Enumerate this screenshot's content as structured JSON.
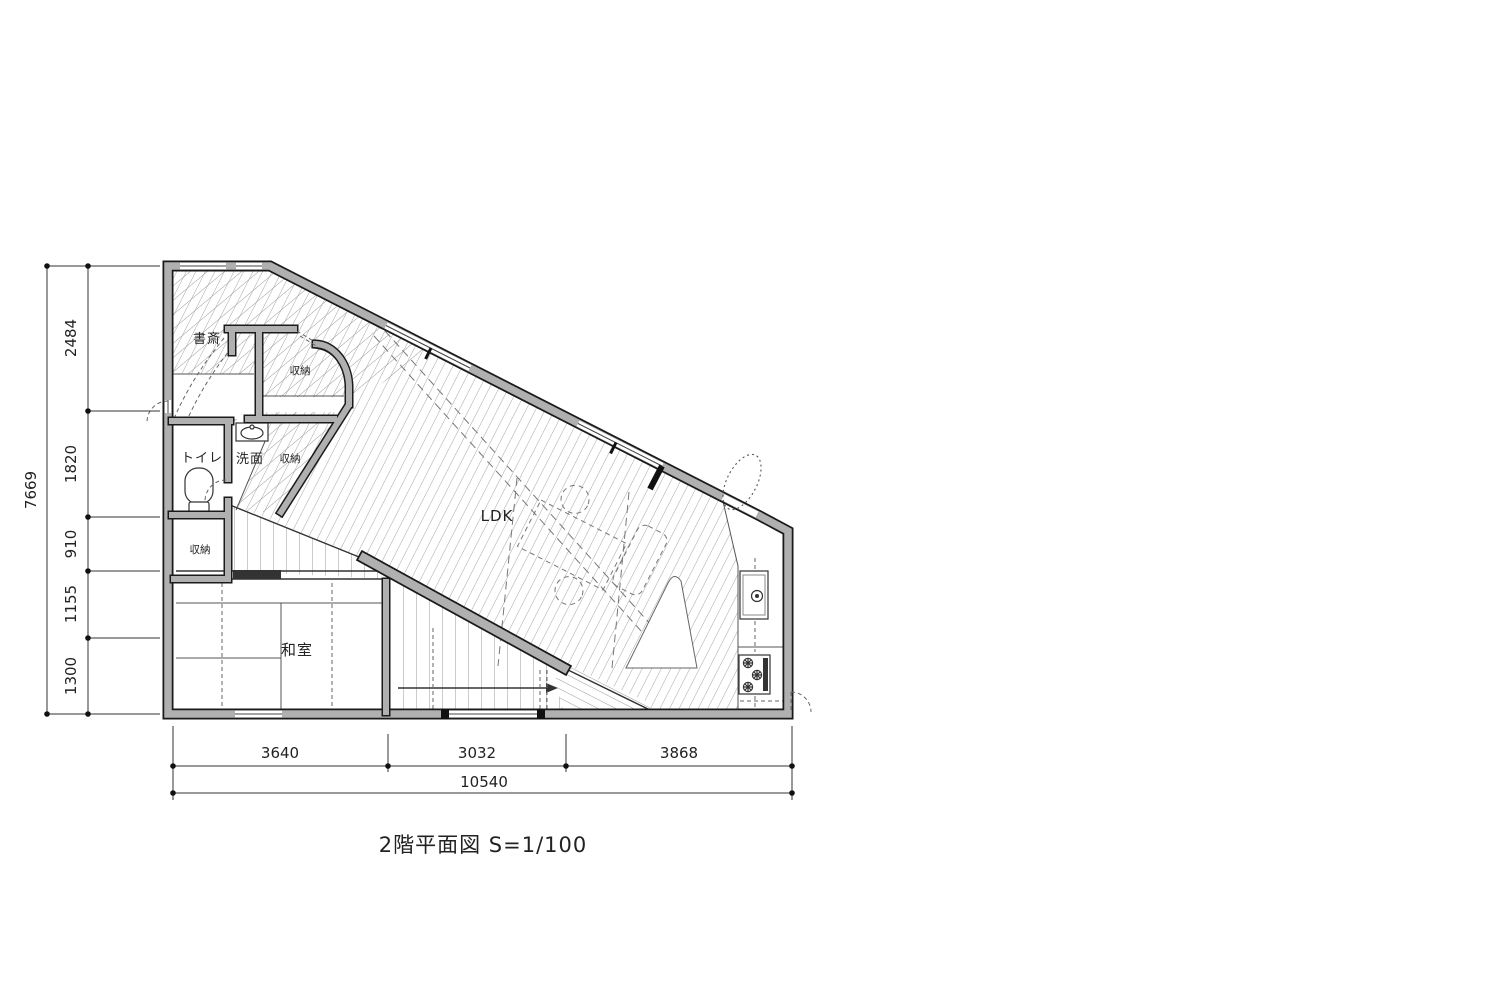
{
  "drawing": {
    "title": "2階平面図 S=1/100",
    "rooms": {
      "study": "書斎",
      "closet_top": "収納",
      "toilet": "トイレ",
      "washroom": "洗面",
      "closet_mid": "収納",
      "closet_left": "収納",
      "ldk": "LDK",
      "japanese_room": "和室"
    },
    "dimensions": {
      "left": {
        "total": "7669",
        "segments": [
          "2484",
          "1820",
          "910",
          "1155",
          "1300"
        ]
      },
      "bottom": {
        "total": "10540",
        "segments": [
          "3640",
          "3032",
          "3868"
        ]
      }
    },
    "colors": {
      "wall_fill": "#b0b0b0",
      "wall_edge": "#1a1a1a",
      "hatch": "#9b9b9b",
      "background": "#ffffff"
    }
  }
}
